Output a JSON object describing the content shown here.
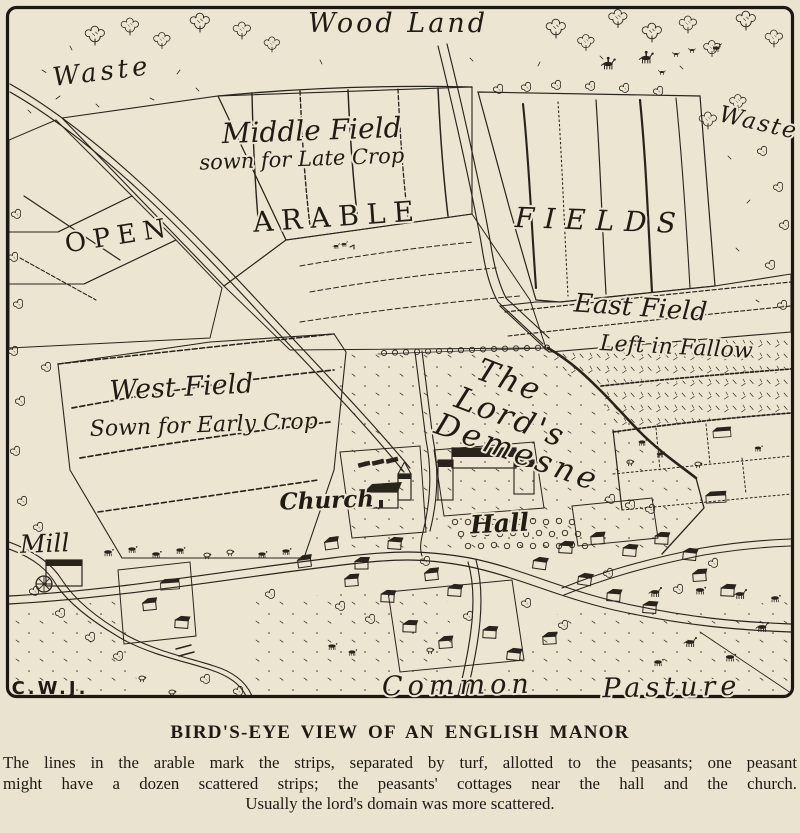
{
  "figure": {
    "signature": "C.W.J."
  },
  "map": {
    "labels": {
      "woodland": "Wood Land",
      "waste_left": "Waste",
      "waste_right": "Waste",
      "middle_field": "Middle Field",
      "middle_field_note": "sown for Late Crop",
      "arable": "ARABLE",
      "fields": "FIELDS",
      "open": "OPEN",
      "east_field": "East Field",
      "east_field_note": "Left in Fallow",
      "west_field": "West Field",
      "west_field_note": "Sown for Early Crop",
      "demesne_line1": "The",
      "demesne_line2": "Lord's",
      "demesne_line3": "Demesne",
      "church": "Church",
      "hall": "Hall",
      "mill": "Mill",
      "common": "Common",
      "pasture": "Pasture"
    },
    "colors": {
      "paper": "#ebe5d1",
      "ink": "#29241b",
      "frame": "#1d1810"
    }
  },
  "caption": {
    "title": "BIRD'S-EYE VIEW OF AN ENGLISH MANOR",
    "line1": "The lines in the arable mark the strips, separated by turf, allotted to the peasants; one peasant",
    "line2": "might have a dozen scattered strips; the peasants' cottages near the hall and the church.",
    "line3": "Usually the lord's domain was more scattered."
  }
}
